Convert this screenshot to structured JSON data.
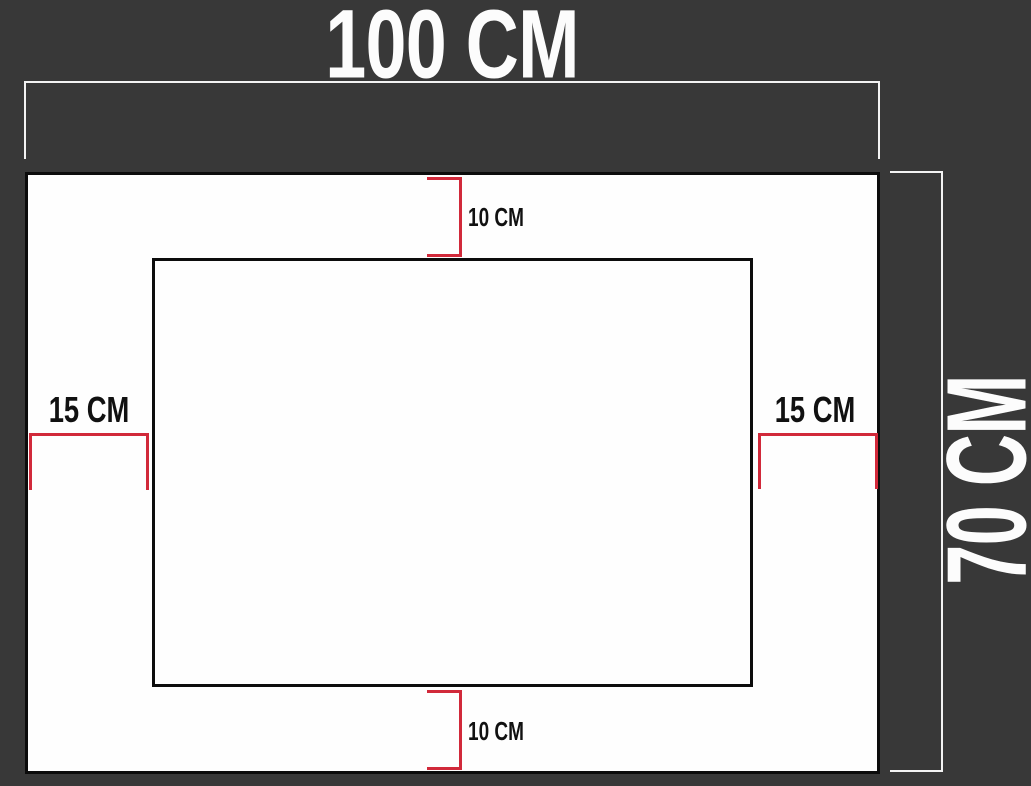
{
  "diagram": {
    "type": "dimension-drawing",
    "width_label": "100 CM",
    "height_label": "70 CM",
    "top_margin_label": "10 CM",
    "bottom_margin_label": "10 CM",
    "left_margin_label": "15 CM",
    "right_margin_label": "15 CM"
  },
  "colors": {
    "background": "#383838",
    "panel": "#fefefe",
    "outline": "#0c0c0c",
    "dimension_line": "#f3f3f3",
    "margin_accent": "#d1293a",
    "label_on_dark": "#fcfcfc",
    "label_on_light": "#111111"
  }
}
